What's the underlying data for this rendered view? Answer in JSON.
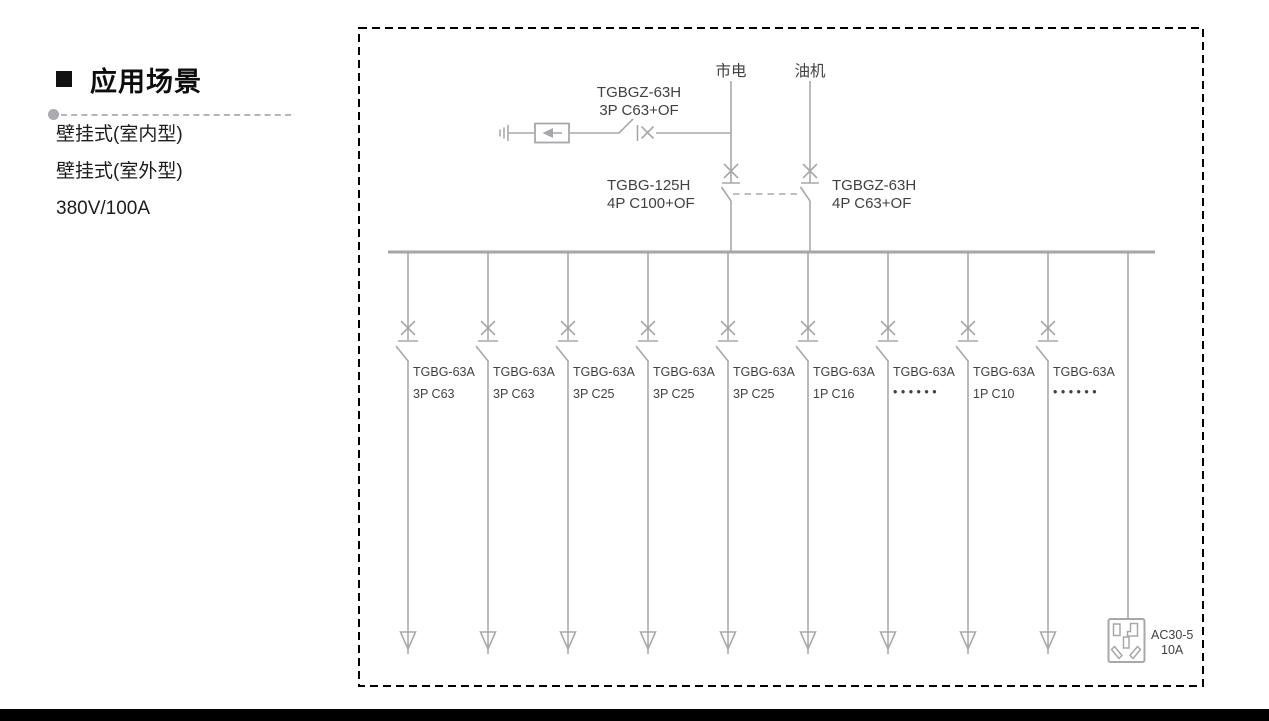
{
  "left_panel": {
    "heading": "应用场景",
    "items": [
      "壁挂式(室内型)",
      "壁挂式(室外型)",
      "380V/100A"
    ]
  },
  "diagram": {
    "mains_source_label": "市电",
    "generator_source_label": "油机",
    "spd_branch_breaker": {
      "model": "TGBGZ-63H",
      "spec": "3P C63+OF"
    },
    "mains_breaker": {
      "model": "TGBG-125H",
      "spec": "4P C100+OF"
    },
    "generator_breaker": {
      "model": "TGBGZ-63H",
      "spec": "4P C63+OF"
    },
    "feeders": [
      {
        "model": "TGBG-63A",
        "spec": "3P C63"
      },
      {
        "model": "TGBG-63A",
        "spec": "3P C63"
      },
      {
        "model": "TGBG-63A",
        "spec": "3P C25"
      },
      {
        "model": "TGBG-63A",
        "spec": "3P C25"
      },
      {
        "model": "TGBG-63A",
        "spec": "3P C25"
      },
      {
        "model": "TGBG-63A",
        "spec": "1P C16"
      },
      {
        "model": "TGBG-63A",
        "spec": "• • • • • •"
      },
      {
        "model": "TGBG-63A",
        "spec": "1P C10"
      },
      {
        "model": "TGBG-63A",
        "spec": "• • • • • •"
      }
    ],
    "socket": {
      "model": "AC30-5",
      "rating": "10A"
    }
  },
  "colors": {
    "diagram_line_gray": "#a6a8ab",
    "diagram_label_gray": "#414042",
    "border_black": "#000000",
    "bottom_bar_black": "#000000"
  }
}
